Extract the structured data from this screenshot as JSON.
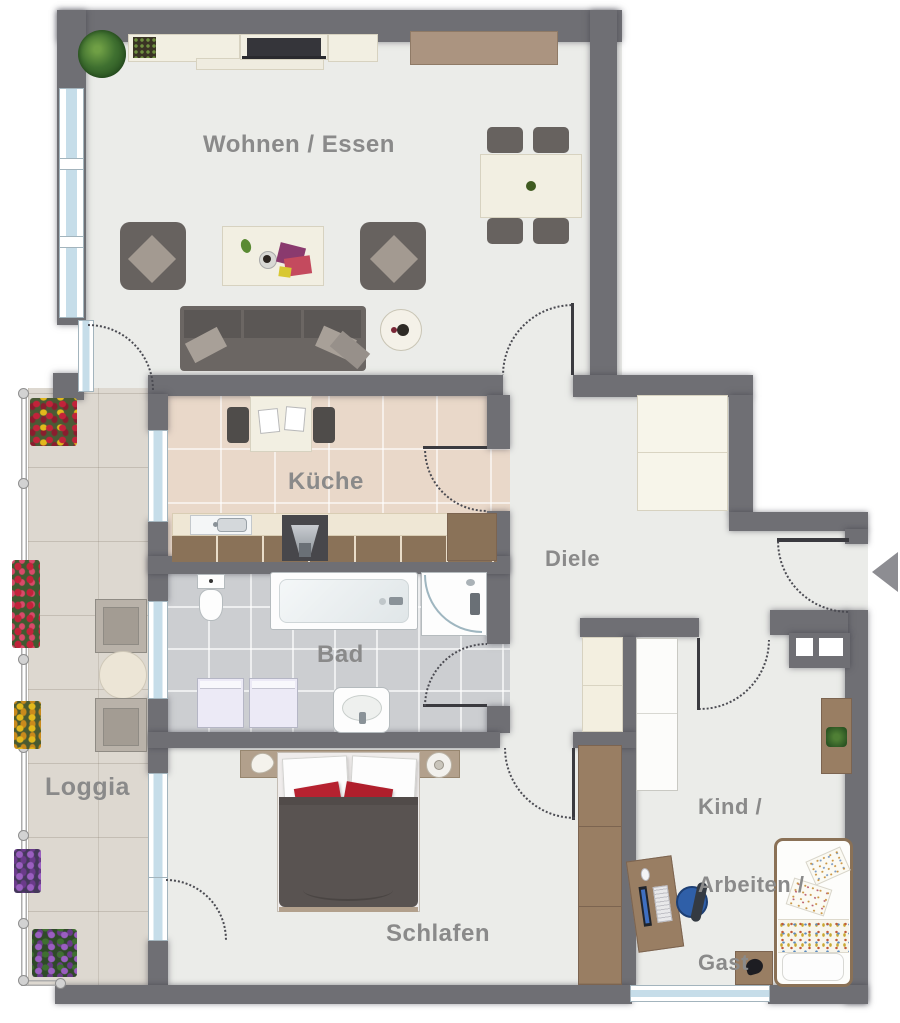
{
  "rooms": {
    "living": {
      "label": "Wohnen / Essen"
    },
    "kitchen": {
      "label": "Küche"
    },
    "hallway": {
      "label": "Diele"
    },
    "bathroom": {
      "label": "Bad"
    },
    "loggia": {
      "label": "Loggia"
    },
    "bedroom": {
      "label": "Schlafen"
    },
    "kids_room": {
      "lines": [
        "Kind /",
        "Arbeiten /",
        "Gast"
      ]
    }
  },
  "colors": {
    "wall": "#6f6f74",
    "floor_default": "#ebece9",
    "floor_kitchen": "#e9d8c9",
    "floor_bath": "#ccced1",
    "floor_loggia": "#ddd8d0",
    "label_text": "#8a8a8a",
    "wood_dark": "#997e63",
    "wood_light": "#f2efe2",
    "upholstery": "#67625f",
    "accent_red": "#b62230",
    "window_glass": "#c6dde9",
    "entry_arrow": "#8d8d92"
  },
  "entry": {
    "marker": "entry-arrow"
  }
}
